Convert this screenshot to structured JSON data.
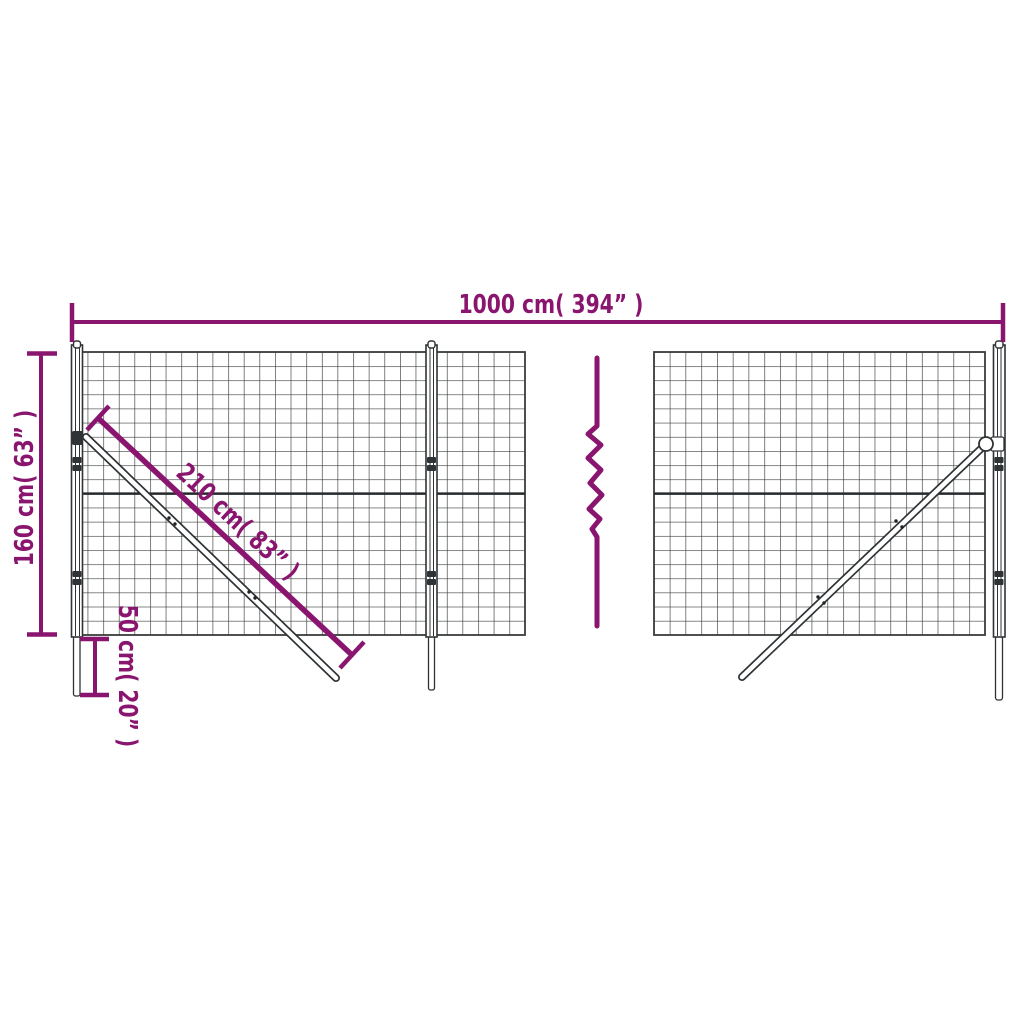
{
  "labels": {
    "width": "1000 cm( 394” )",
    "height": "160 cm( 63” )",
    "diagonal": "210 cm( 83” )",
    "offset": "50 cm( 20” )"
  },
  "colors": {
    "dimension": "#8A156F",
    "mesh": "#3A3D3B",
    "mesh_mid_wire": "#26292B",
    "background": "#FFFFFF"
  }
}
